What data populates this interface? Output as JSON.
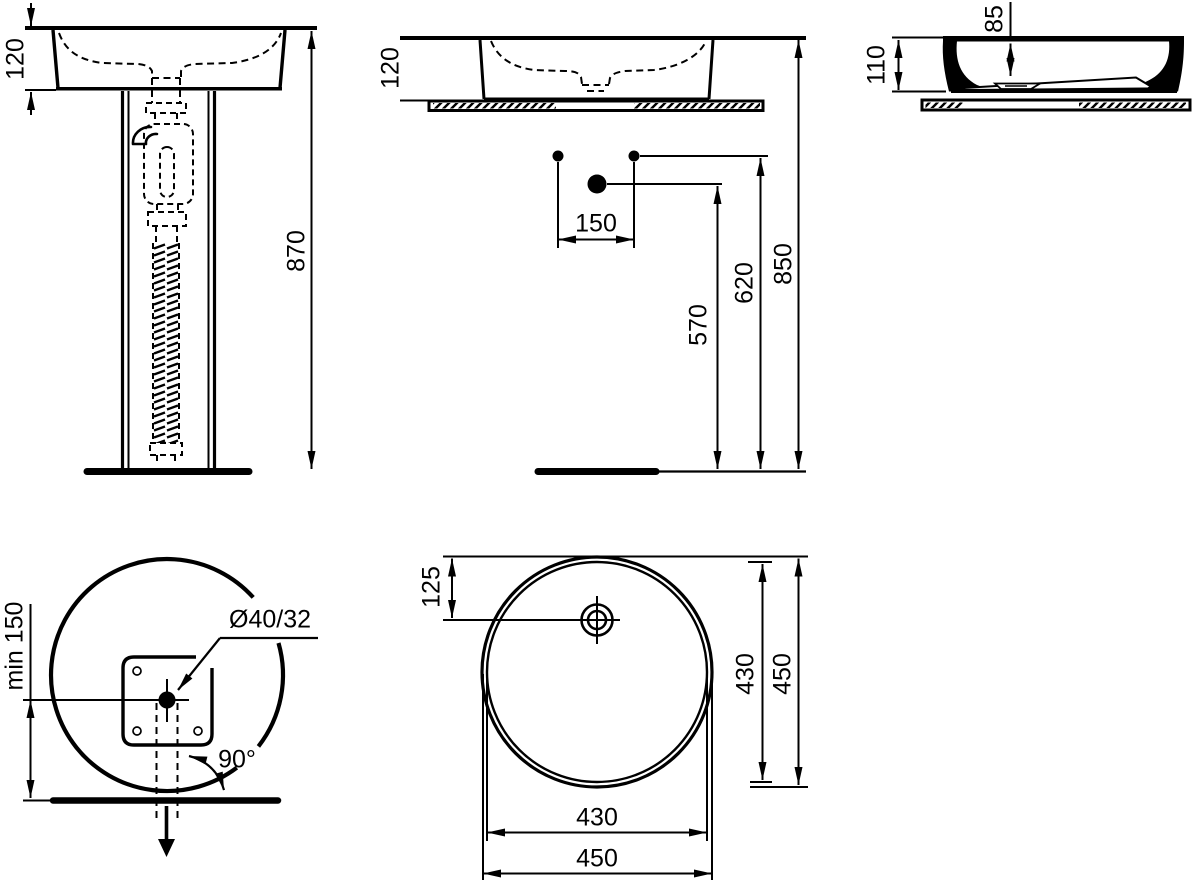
{
  "title": "Washbasin installation technical drawing",
  "colors": {
    "ink": "#000000",
    "paper": "#ffffff"
  },
  "views": {
    "front_pedestal": {
      "name": "front view with full pedestal",
      "basin_height": "120",
      "overall_height": "870"
    },
    "front_countertop": {
      "name": "front view on countertop",
      "basin_height": "120",
      "tap_hole_spacing": "150",
      "drain_outlet_height": "570",
      "water_supply_height": "620",
      "rim_height": "850"
    },
    "side_section": {
      "name": "side section on countertop",
      "bowl_depth": "85",
      "basin_height": "110"
    },
    "top_pedestal": {
      "name": "top view with pedestal",
      "min_wall_distance": "min 150",
      "waste_pipe_diameter": "Ø40/32",
      "swivel_angle": "90°"
    },
    "top_basin": {
      "name": "top view round basin",
      "drain_center_offset": "125",
      "inner_diameter_vertical": "430",
      "outer_diameter_vertical": "450",
      "inner_diameter_horizontal": "430",
      "outer_diameter_horizontal": "450"
    }
  }
}
